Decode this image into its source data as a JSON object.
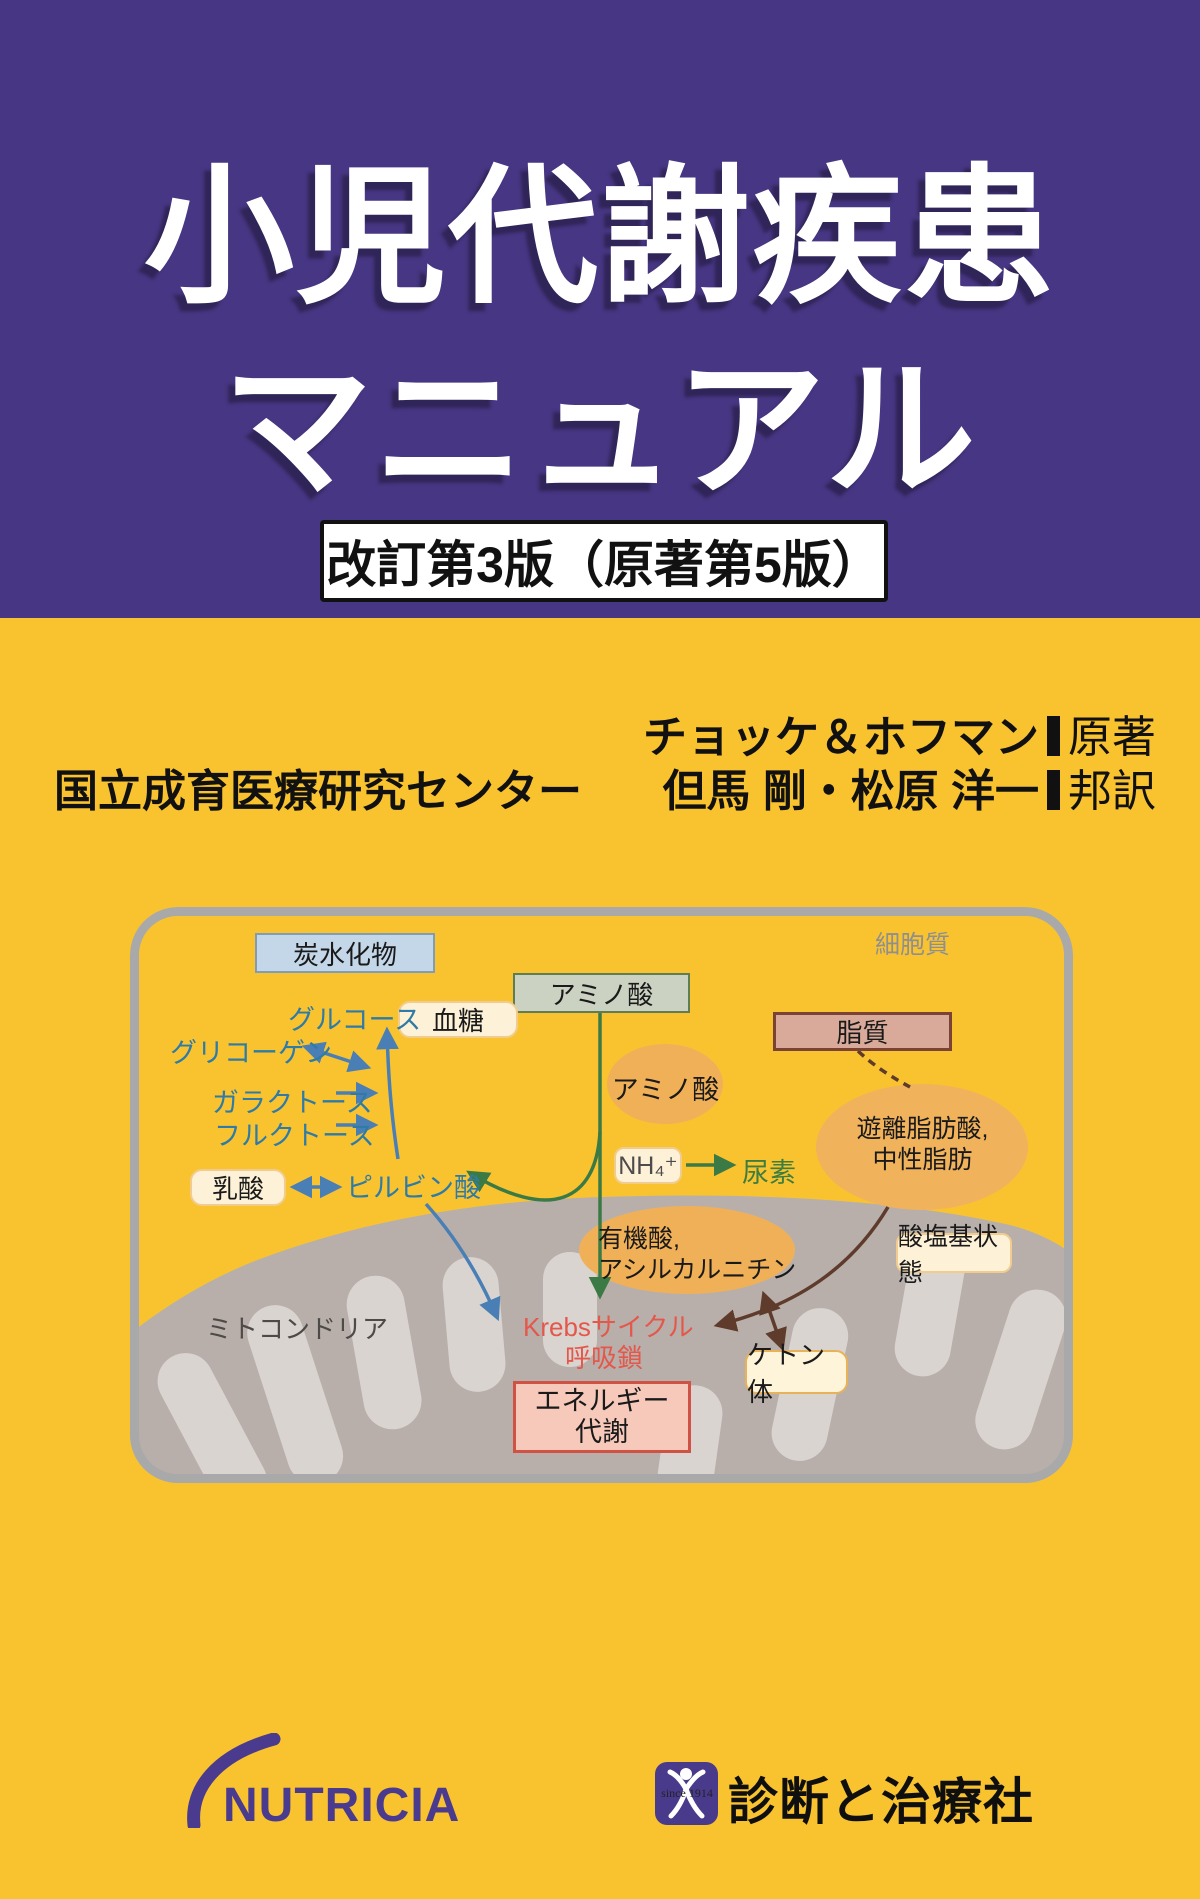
{
  "cover": {
    "title_line1": "小児代謝疾患",
    "title_line2": "マニュアル",
    "edition_badge": "改訂第3版（原著第5版）",
    "authors": {
      "original_authors": "チョッケ＆ホフマン",
      "original_role": "原著",
      "institution": "国立成育医療研究センター",
      "translators": "但馬 剛・松原 洋一",
      "translation_role": "邦訳"
    },
    "colors": {
      "panel_purple": "#473683",
      "cover_yellow": "#f9c330",
      "krebs_red": "#e4574b",
      "sugar_blue": "#2f7ba6",
      "arrow_blue": "#4a7fb5",
      "arrow_green": "#3c7a45",
      "arrow_brown": "#5f3b2b"
    }
  },
  "diagram": {
    "cytosol_label": "細胞質",
    "mitochondria_label": "ミトコンドリア",
    "boxes": {
      "carbohydrate": "炭水化物",
      "amino_acid": "アミノ酸",
      "lipid": "脂質",
      "blood_sugar": "血糖",
      "lactate": "乳酸",
      "ammonium": "NH₄⁺",
      "ketone_body": "ケトン体",
      "acid_base_status": "酸塩基状態",
      "energy_line1": "エネルギー",
      "energy_line2": "代謝"
    },
    "labels": {
      "glucose": "グルコース",
      "glycogen": "グリコーゲン",
      "galactose": "ガラクトース",
      "fructose": "フルクトース",
      "pyruvate": "ピルビン酸",
      "urea": "尿素",
      "amino_acid_pool": "アミノ酸",
      "free_fatty_line1": "遊離脂肪酸,",
      "free_fatty_line2": "中性脂肪",
      "organic_line1": "有機酸,",
      "organic_line2": "アシルカルニチン",
      "krebs_line1": "Krebsサイクル",
      "krebs_line2": "呼吸鎖"
    }
  },
  "footer": {
    "nutricia_logo": "NUTRICIA",
    "publisher_name": "診断と治療社",
    "publisher_mark_text": "since 1914"
  }
}
